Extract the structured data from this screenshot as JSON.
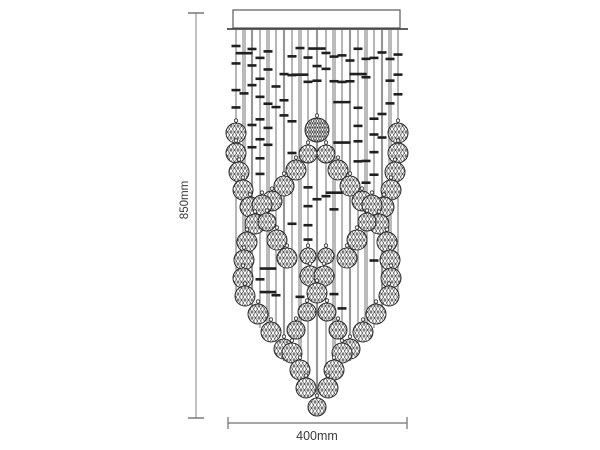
{
  "diagram": {
    "kind": "chandelier-dimension-drawing",
    "height_label": "850mm",
    "width_label": "400mm",
    "colors": {
      "background": "#ffffff",
      "wire_dark": "#2e2e2e",
      "wire_light": "#b5b5b5",
      "bead": "#1f1f1f",
      "ball_stroke": "#2a2a2a",
      "mesh": "#3f3f3f",
      "dim_line": "#9a9a9a",
      "dim_cap": "#6f6f6f",
      "dim_text": "#3a3a3a",
      "canopy_stroke": "#4a4a4a"
    },
    "canopy": {
      "x": 233,
      "y": 10,
      "w": 167,
      "h": 18,
      "flange_x1": 227,
      "flange_x2": 408,
      "flange_y": 29
    },
    "dims": {
      "height": {
        "x": 196,
        "y1": 13,
        "y2": 418,
        "cap_half": 8,
        "label_x": 188,
        "label_y": 200
      },
      "width": {
        "y": 423,
        "x1": 228,
        "x2": 407,
        "tick_half": 6,
        "label_x": 317,
        "label_y": 440
      }
    },
    "wires": [
      [
        236,
        300,
        0
      ],
      [
        244,
        306,
        2
      ],
      [
        252,
        317,
        1
      ],
      [
        260,
        328,
        0
      ],
      [
        268,
        339,
        2
      ],
      [
        276,
        350,
        0
      ],
      [
        284,
        361,
        1
      ],
      [
        292,
        372,
        0
      ],
      [
        300,
        383,
        2
      ],
      [
        308,
        394,
        0
      ],
      [
        317,
        408,
        1
      ],
      [
        326,
        394,
        0
      ],
      [
        334,
        383,
        2
      ],
      [
        342,
        372,
        0
      ],
      [
        350,
        361,
        1
      ],
      [
        358,
        350,
        0
      ],
      [
        366,
        339,
        2
      ],
      [
        374,
        328,
        0
      ],
      [
        382,
        317,
        1
      ],
      [
        390,
        306,
        2
      ],
      [
        398,
        300,
        0
      ]
    ],
    "balls": [
      [
        317,
        130,
        12
      ],
      [
        308,
        154,
        9
      ],
      [
        326,
        154,
        9
      ],
      [
        296,
        170,
        10
      ],
      [
        338,
        170,
        10
      ],
      [
        284,
        186,
        10
      ],
      [
        350,
        186,
        10
      ],
      [
        272,
        201,
        10
      ],
      [
        362,
        201,
        10
      ],
      [
        236,
        133,
        10
      ],
      [
        398,
        133,
        10
      ],
      [
        236,
        153,
        10
      ],
      [
        398,
        153,
        10
      ],
      [
        239,
        172,
        10
      ],
      [
        395,
        172,
        10
      ],
      [
        243,
        190,
        10
      ],
      [
        391,
        190,
        10
      ],
      [
        250,
        207,
        10
      ],
      [
        384,
        207,
        10
      ],
      [
        262,
        205,
        10
      ],
      [
        372,
        205,
        10
      ],
      [
        255,
        224,
        10
      ],
      [
        379,
        224,
        10
      ],
      [
        267,
        222,
        9
      ],
      [
        367,
        222,
        9
      ],
      [
        247,
        242,
        10
      ],
      [
        387,
        242,
        10
      ],
      [
        244,
        260,
        10
      ],
      [
        390,
        260,
        10
      ],
      [
        243,
        278,
        10
      ],
      [
        391,
        278,
        10
      ],
      [
        245,
        296,
        10
      ],
      [
        389,
        296,
        10
      ],
      [
        277,
        240,
        10
      ],
      [
        357,
        240,
        10
      ],
      [
        287,
        258,
        10
      ],
      [
        347,
        258,
        10
      ],
      [
        308,
        256,
        8
      ],
      [
        326,
        256,
        8
      ],
      [
        310,
        276,
        10
      ],
      [
        324,
        276,
        10
      ],
      [
        317,
        293,
        10
      ],
      [
        307,
        312,
        9
      ],
      [
        327,
        312,
        9
      ],
      [
        296,
        330,
        9
      ],
      [
        338,
        330,
        9
      ],
      [
        258,
        314,
        10
      ],
      [
        376,
        314,
        10
      ],
      [
        271,
        332,
        10
      ],
      [
        363,
        332,
        10
      ],
      [
        284,
        349,
        10
      ],
      [
        350,
        349,
        10
      ],
      [
        292,
        353,
        10
      ],
      [
        342,
        353,
        10
      ],
      [
        300,
        370,
        10
      ],
      [
        334,
        370,
        10
      ],
      [
        306,
        388,
        10
      ],
      [
        328,
        388,
        10
      ],
      [
        317,
        407,
        9
      ]
    ],
    "dash_params": {
      "y_start": 46,
      "y_stop_max": 318,
      "step_min": 14,
      "step_var": 13,
      "keep_upper": 0.8,
      "keep_lower": 0.5,
      "upper_limit": 132,
      "w_normal": 9,
      "w_wide": 17,
      "wide_prob": 0.13,
      "thickness": 2.6
    },
    "extra_dashes": [
      [
        308,
        249
      ],
      [
        326,
        249
      ],
      [
        317,
        264
      ],
      [
        308,
        299
      ],
      [
        326,
        299
      ],
      [
        317,
        299
      ]
    ]
  }
}
